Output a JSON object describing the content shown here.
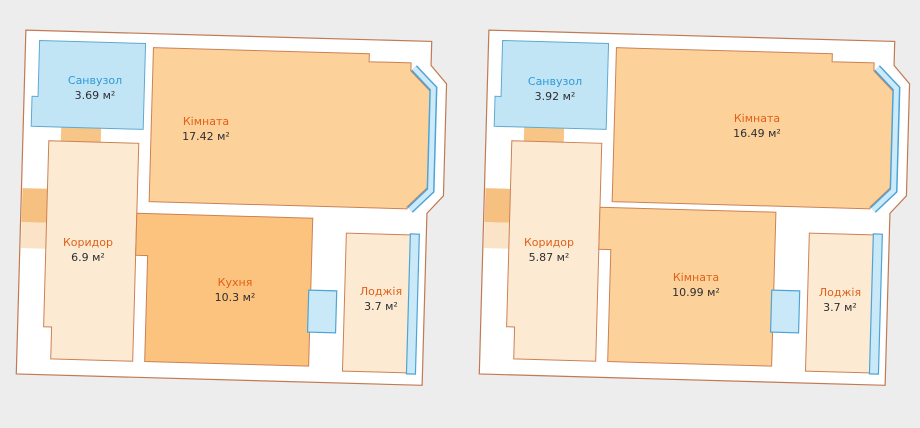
{
  "page": {
    "background": "#ededee",
    "description": "Two apartment floor plans side by side"
  },
  "palette": {
    "wall_fill": "#ffffff",
    "outline": "#c17a52",
    "room_orange": "#fdd29a",
    "kitchen_orange": "#fcc37e",
    "corridor_cream": "#fcebd2",
    "bathroom_blue": "#c2e5f6",
    "window_fill": "#c9e9f9",
    "window_border": "#4ea4d4",
    "door_opening": "#f6c180",
    "label_orange": "#e0601a",
    "label_blue": "#2e9ad6",
    "value_dark": "#2e2e33"
  },
  "plans": [
    {
      "name": "floor-plan-left",
      "rooms": [
        {
          "key": "bathroom",
          "label": "Санвузол",
          "area": "3.69 м²"
        },
        {
          "key": "living-room",
          "label": "Кімната",
          "area": "17.42 м²"
        },
        {
          "key": "corridor",
          "label": "Коридор",
          "area": "6.9 м²"
        },
        {
          "key": "kitchen",
          "label": "Кухня",
          "area": "10.3 м²"
        },
        {
          "key": "loggia",
          "label": "Лоджія",
          "area": "3.7 м²"
        }
      ]
    },
    {
      "name": "floor-plan-right",
      "rooms": [
        {
          "key": "bathroom",
          "label": "Санвузол",
          "area": "3.92 м²"
        },
        {
          "key": "living-room",
          "label": "Кімната",
          "area": "16.49 м²"
        },
        {
          "key": "corridor",
          "label": "Коридор",
          "area": "5.87 м²"
        },
        {
          "key": "room-2",
          "label": "Кімната",
          "area": "10.99 м²"
        },
        {
          "key": "loggia",
          "label": "Лоджія",
          "area": "3.7 м²"
        }
      ]
    }
  ]
}
